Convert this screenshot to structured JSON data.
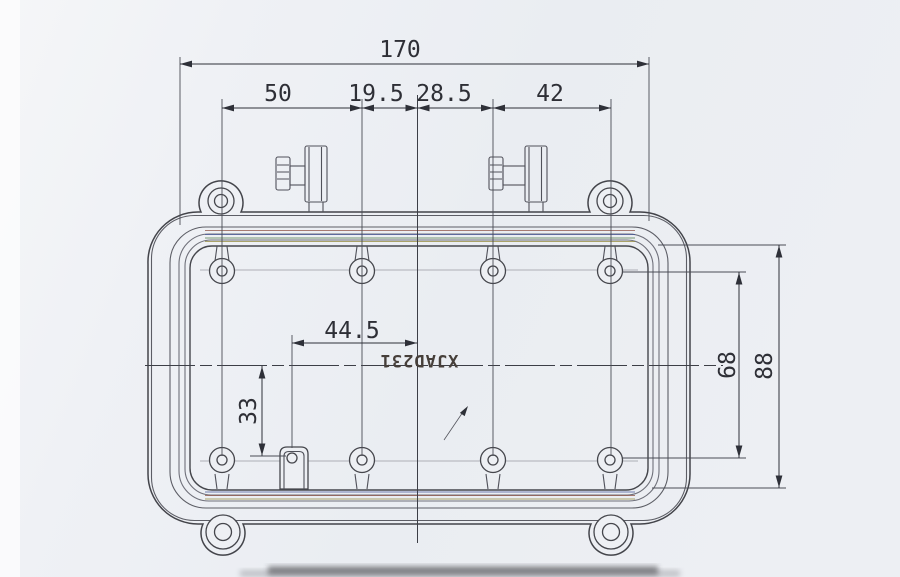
{
  "document": {
    "kind": "scanned engineering drawing",
    "view": "enclosure cover top view"
  },
  "part_marking": {
    "text": "XJAD231",
    "orientation": "rotated-180"
  },
  "dimensions": {
    "overall_width": {
      "label": "170"
    },
    "hole_spacing": [
      {
        "label": "50"
      },
      {
        "label": "19.5"
      },
      {
        "label": "28.5"
      },
      {
        "label": "42"
      }
    ],
    "boss_offset_horizontal": {
      "label": "44.5"
    },
    "center_to_bottom_row": {
      "label": "33"
    },
    "hole_rows_spacing": {
      "label": "68"
    },
    "opening_height": {
      "label": "88"
    }
  },
  "colors": {
    "paper": "#eef0f4",
    "paper_light": "#f6f7f9",
    "line": "#43444a",
    "dimension": "#2e3038",
    "marking": "#463f3a",
    "scan_fringe_red": "#8a4a3c",
    "scan_fringe_blue": "#3d4e93",
    "scan_fringe_green": "#44723c",
    "scan_fringe_olive": "#8f8430",
    "scan_edge_smudge": "#2f2f33"
  }
}
